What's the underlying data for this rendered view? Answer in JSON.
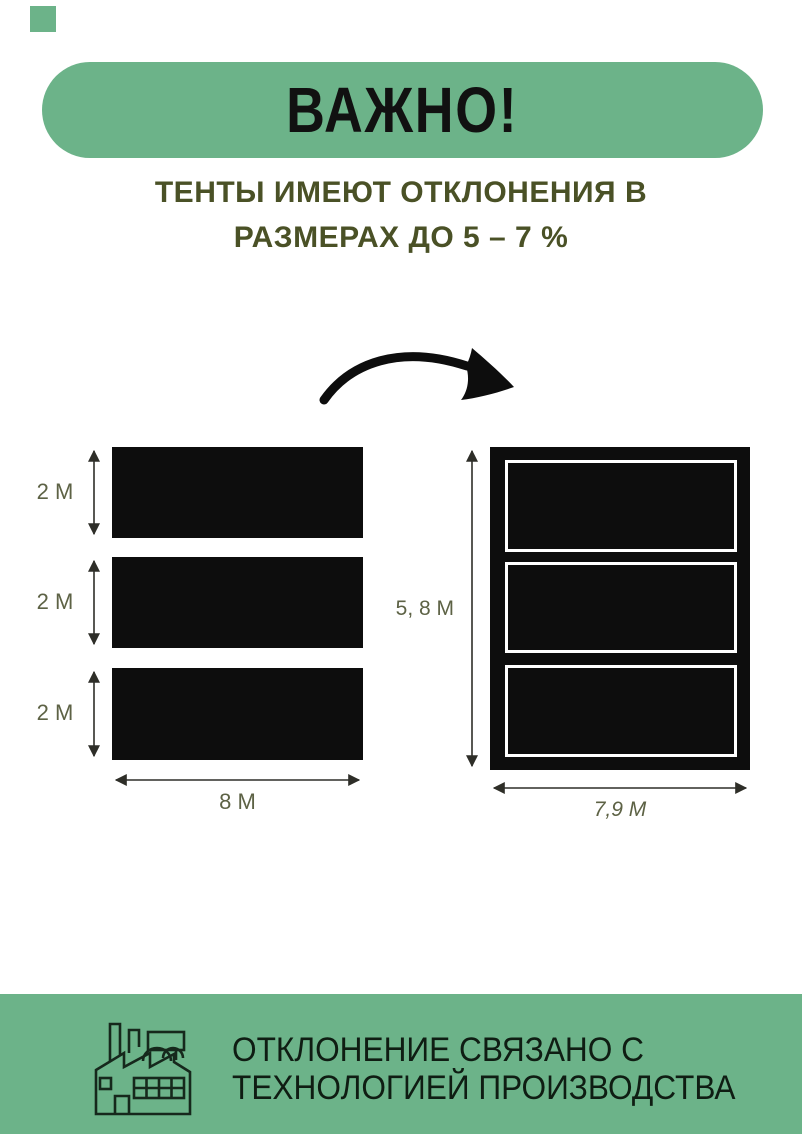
{
  "colors": {
    "green": "#6cb389",
    "subtitle_olive": "#4a5126",
    "dimension_olive": "#5d6245",
    "shape_black": "#0d0d0d",
    "title_text": "#111111",
    "footer_text": "#0f1d13"
  },
  "banner": {
    "title": "ВАЖНО!"
  },
  "subtitle": {
    "line1": "ТЕНТЫ ИМЕЮТ ОТКЛОНЕНИЯ В",
    "line2": "РАЗМЕРАХ ДО 5 – 7 %"
  },
  "left_diagram": {
    "panel_height_labels": [
      "2 М",
      "2 М",
      "2 М"
    ],
    "width_label": "8 М"
  },
  "right_diagram": {
    "height_label": "5, 8 М",
    "width_label": "7,9 М"
  },
  "footer": {
    "line1": "ОТКЛОНЕНИЕ СВЯЗАНО С",
    "line2": "ТЕХНОЛОГИЕЙ ПРОИЗВОДСТВА"
  },
  "icons": {
    "arrow": "curved-arrow-icon",
    "factory": "factory-icon"
  }
}
